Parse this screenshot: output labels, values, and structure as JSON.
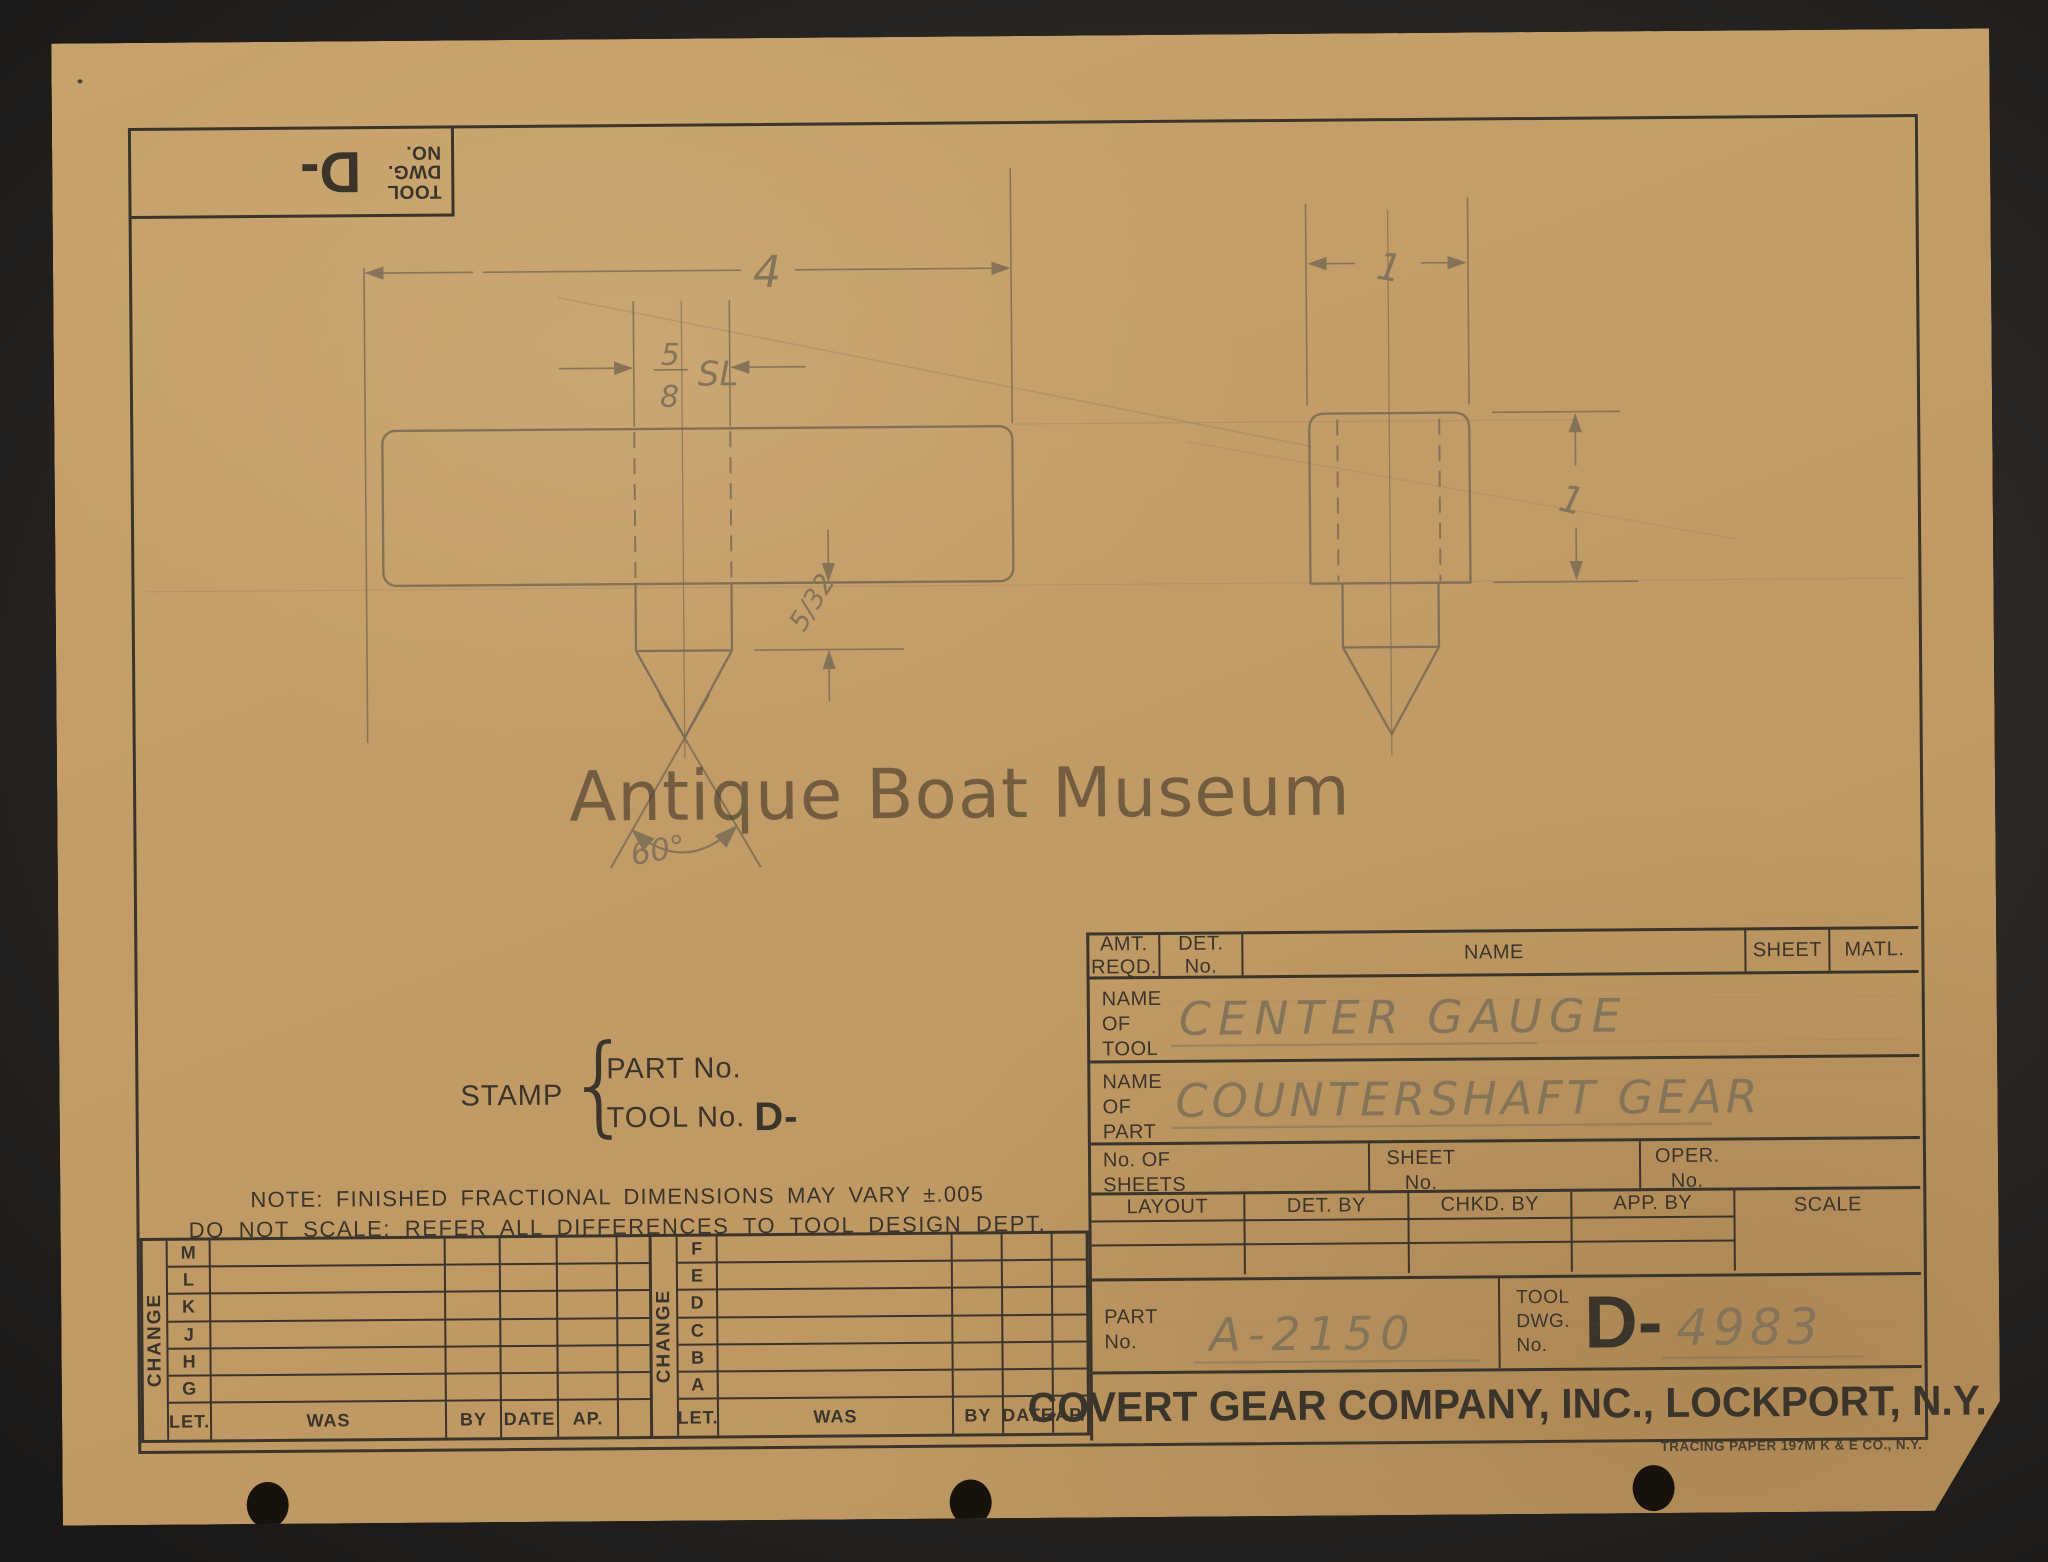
{
  "watermark": "Antique Boat Museum",
  "stamp_box": {
    "label": "TOOL DWG. NO.",
    "big": "D-"
  },
  "drawing": {
    "dim_length": "4",
    "dim_hole_num": "5",
    "dim_hole_den": "8",
    "dim_hole_suffix": "SL",
    "dim_tip": "5/32",
    "dim_angle": "60°",
    "dim_width": "1",
    "dim_height": "1"
  },
  "stamp_note": {
    "stamp": "STAMP",
    "brace": "{",
    "part_line": "PART No.",
    "tool_line": "TOOL No.",
    "tool_big": "D-"
  },
  "note": "NOTE: FINISHED FRACTIONAL DIMENSIONS MAY VARY ±.005",
  "do_not_scale": "DO NOT SCALE; REFER ALL DIFFERENCES TO TOOL DESIGN DEPT.",
  "change_tables": {
    "label": "CHANGE",
    "left_letters": [
      "M",
      "L",
      "K",
      "J",
      "H",
      "G"
    ],
    "right_letters": [
      "F",
      "E",
      "D",
      "C",
      "B",
      "A"
    ],
    "footer": {
      "let": "LET.",
      "was": "WAS",
      "by": "BY",
      "date": "DATE",
      "ap": "AP."
    }
  },
  "title_block": {
    "header": {
      "amt": "AMT. REQD.",
      "det": "DET. No.",
      "name": "NAME",
      "sheet": "SHEET",
      "matl": "MATL."
    },
    "tool_row": {
      "label": "NAME OF TOOL",
      "value": "CENTER GAUGE"
    },
    "part_row": {
      "label": "NAME OF PART",
      "value": "COUNTERSHAFT GEAR"
    },
    "sheets_row": {
      "no_of_sheets": "No. OF SHEETS",
      "sheet_no": "SHEET No.",
      "oper_no": "OPER. No."
    },
    "sign_row": {
      "layout": "LAYOUT",
      "det_by": "DET. BY",
      "chkd_by": "CHKD. BY",
      "app_by": "APP. BY",
      "scale": "SCALE"
    },
    "part_no": {
      "label": "PART No.",
      "value": "A-2150"
    },
    "tool_dwg": {
      "label": "TOOL DWG. No.",
      "prefix": "D-",
      "value": "4983"
    },
    "company": "COVERT GEAR COMPANY, INC., LOCKPORT, N.Y."
  },
  "footer_note": "TRACING PAPER 197M K & E CO., N.Y.",
  "colors": {
    "paper": "#c29c66",
    "ink": "#3a342b",
    "pencil": "#7b6c55",
    "desk": "#2b2826"
  }
}
